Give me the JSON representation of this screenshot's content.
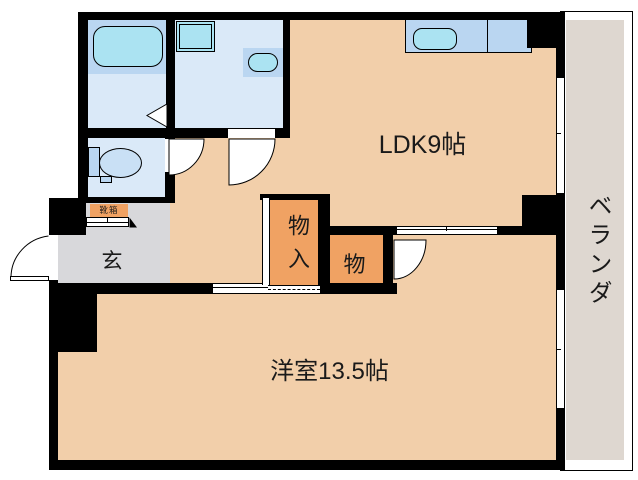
{
  "floorplan": {
    "title": "apartment-floor-plan",
    "rooms": {
      "ldk": {
        "label": "LDK9帖"
      },
      "western_room": {
        "label": "洋室13.5帖"
      },
      "entrance": {
        "label": "玄"
      },
      "closet_large": {
        "label": "物入"
      },
      "closet_small": {
        "label": "物"
      },
      "shoe_box": {
        "label": "靴箱"
      },
      "veranda": {
        "label": "ベランダ"
      }
    },
    "colors": {
      "room_floor": "#F2CFAA",
      "closet": "#F0A263",
      "entrance_floor": "#D8D8DB",
      "veranda_floor": "#DED7D0",
      "wet_area_floor": "#DAE9F8",
      "fixture_blue": "#BAD6F1",
      "fixture_cyan": "#ABE3F2",
      "toilet_bowl": "#C9E0F5",
      "wall": "#000000"
    }
  }
}
